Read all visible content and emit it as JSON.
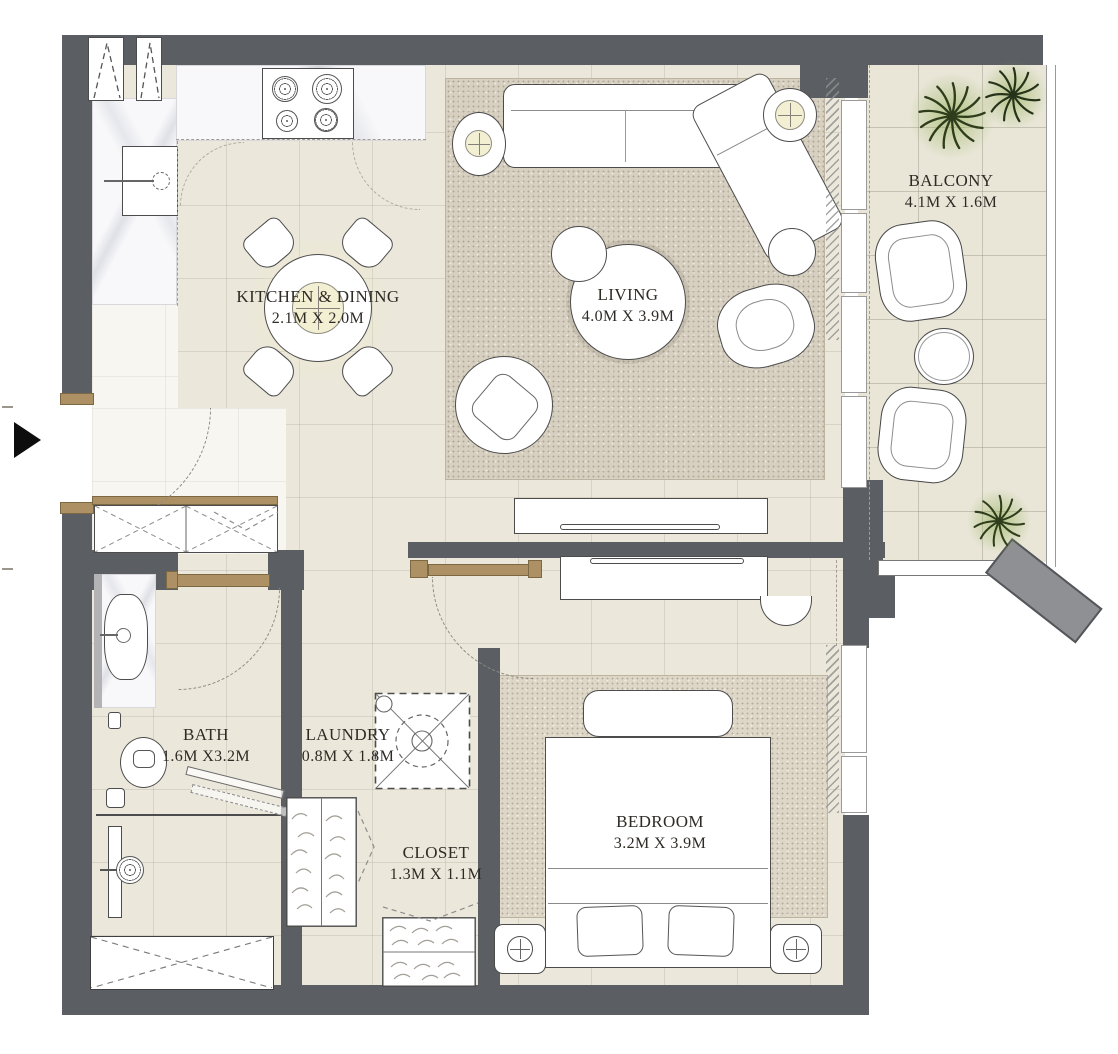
{
  "plan": {
    "rooms": {
      "kitchen": {
        "label": "KITCHEN & DINING",
        "dims": "2.1M X 2.0M"
      },
      "living": {
        "label": "LIVING",
        "dims": "4.0M X 3.9M"
      },
      "balcony": {
        "label": "BALCONY",
        "dims": "4.1M X 1.6M"
      },
      "bath": {
        "label": "BATH",
        "dims": "1.6M X3.2M"
      },
      "laundry": {
        "label": "LAUNDRY",
        "dims": "0.8M X 1.8M"
      },
      "closet": {
        "label": "CLOSET",
        "dims": "1.3M X 1.1M"
      },
      "bedroom": {
        "label": "BEDROOM",
        "dims": "3.2M X 3.9M"
      }
    },
    "colors": {
      "wall": "#5b5e63",
      "floor": "#ebe7da",
      "rug": "#d7d0c0",
      "wood": "#ad9064",
      "plant": "#2f3d1c",
      "accent": "#f3efd3"
    }
  }
}
